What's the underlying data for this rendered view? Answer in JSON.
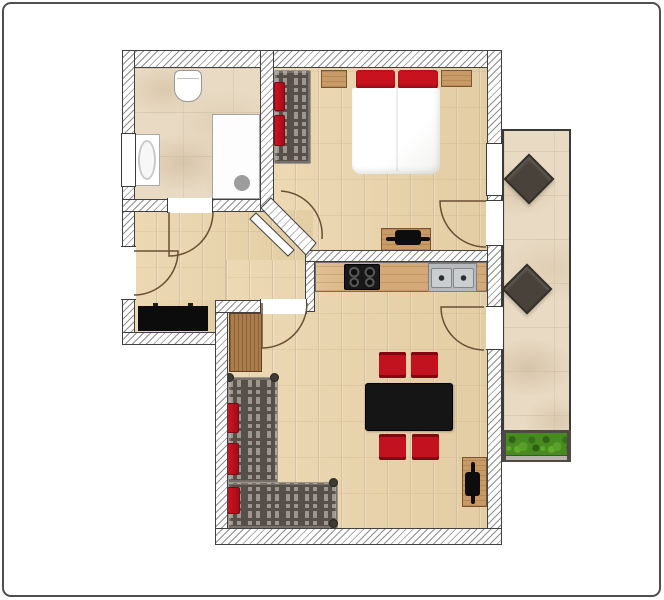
{
  "scene": {
    "title": "apartment-floor-plan",
    "canvas": {
      "w": 664,
      "h": 600,
      "bg": "#ffffff",
      "frame_color": "#4f4f4f"
    },
    "palette": {
      "wall_line": "#414141",
      "door_line": "#6b4f35",
      "wood_floor": "#e9d5ae",
      "stone_floor": "#e8dac3",
      "sofa_dark": "#57504a",
      "accent_red": "#c2121f",
      "furniture_black": "#151515",
      "plant_green": "#478a1f"
    },
    "floors": [
      {
        "name": "bathroom-floor",
        "kind": "stone",
        "x": 133,
        "y": 66,
        "w": 129,
        "h": 135
      },
      {
        "name": "bedroom-floor",
        "kind": "wood",
        "x": 272,
        "y": 66,
        "w": 216,
        "h": 186
      },
      {
        "name": "hallway-floor",
        "kind": "wood",
        "x": 133,
        "y": 210,
        "w": 180,
        "h": 94
      },
      {
        "name": "hallway-floor-ext",
        "kind": "wood",
        "x": 133,
        "y": 300,
        "w": 84,
        "h": 34
      },
      {
        "name": "living-room-floor",
        "kind": "wood",
        "x": 226,
        "y": 260,
        "w": 263,
        "h": 270
      },
      {
        "name": "balcony-floor",
        "kind": "balcony",
        "x": 502,
        "y": 129,
        "w": 69,
        "h": 333
      }
    ],
    "walls": [
      {
        "name": "wall-top",
        "x": 122,
        "y": 50,
        "w": 380,
        "h": 18
      },
      {
        "name": "wall-left",
        "x": 122,
        "y": 50,
        "w": 13,
        "h": 295
      },
      {
        "name": "wall-bathroom-bottom",
        "x": 122,
        "y": 199,
        "w": 152,
        "h": 13
      },
      {
        "name": "wall-bathroom-bedroom",
        "x": 260,
        "y": 50,
        "w": 14,
        "h": 162
      },
      {
        "name": "wall-hall-bottom-left",
        "x": 122,
        "y": 332,
        "w": 95,
        "h": 13
      },
      {
        "name": "wall-living-left",
        "x": 215,
        "y": 300,
        "w": 13,
        "h": 245
      },
      {
        "name": "wall-hall-bottom-right",
        "x": 215,
        "y": 300,
        "w": 92,
        "h": 13
      },
      {
        "name": "wall-mid-vertical",
        "x": 305,
        "y": 250,
        "w": 10,
        "h": 62
      },
      {
        "name": "wall-kitchen",
        "x": 305,
        "y": 250,
        "w": 197,
        "h": 12
      },
      {
        "name": "wall-right",
        "x": 487,
        "y": 50,
        "w": 15,
        "h": 495
      },
      {
        "name": "wall-bottom",
        "x": 215,
        "y": 528,
        "w": 287,
        "h": 17
      }
    ],
    "openings": [
      {
        "name": "bathroom-window-opening",
        "kind": "fp-win-v",
        "x": 121,
        "y": 133,
        "w": 15,
        "h": 54
      },
      {
        "name": "entrance-door-opening",
        "kind": "fp-open-v",
        "x": 121,
        "y": 246,
        "w": 15,
        "h": 54
      },
      {
        "name": "bathroom-door-opening",
        "kind": "fp-open-h",
        "x": 167,
        "y": 198,
        "w": 46,
        "h": 15
      },
      {
        "name": "hall-living-door-opening",
        "kind": "fp-open-h",
        "x": 260,
        "y": 299,
        "w": 47,
        "h": 15
      },
      {
        "name": "bedroom-window-opening",
        "kind": "fp-win-v",
        "x": 486,
        "y": 143,
        "w": 17,
        "h": 53
      },
      {
        "name": "bedroom-balcony-door-opening",
        "kind": "fp-open-v",
        "x": 486,
        "y": 200,
        "w": 17,
        "h": 46
      },
      {
        "name": "living-balcony-door-opening",
        "kind": "fp-open-v",
        "x": 486,
        "y": 306,
        "w": 17,
        "h": 44
      }
    ],
    "wall_polys": [
      {
        "name": "wall-bedroom-diagonal",
        "points": "271,198 316,243 306,255 261,208",
        "fill": "hatch"
      },
      {
        "name": "bedroom-door-leaf",
        "points": "256,213 294,250 288,256 250,219",
        "fill": "#ffffff"
      }
    ],
    "doors": [
      {
        "name": "entrance-door-swing",
        "path": "M 134,251 L 178,251 A 44,44 0 0 1 134,295"
      },
      {
        "name": "bathroom-door-swing",
        "path": "M 169,212 L 169,256 A 44,44 0 0 0 213,212"
      },
      {
        "name": "hall-living-door-swing",
        "path": "M 262,303 L 262,348 A 45,45 0 0 0 307,303"
      },
      {
        "name": "bedroom-door-swing",
        "path": "M 281,191 A 44,44 0 0 1 322,239"
      },
      {
        "name": "bedroom-balcony-door-swing",
        "path": "M 486,201 L 440,201 A 46,46 0 0 0 486,247"
      },
      {
        "name": "living-balcony-door-swing",
        "path": "M 484,307 L 441,307 A 43,43 0 0 0 484,350"
      }
    ],
    "furniture": [
      {
        "name": "toilet",
        "kind": "toilet",
        "x": 174,
        "y": 70,
        "w": 28,
        "h": 32
      },
      {
        "name": "bathroom-sink",
        "kind": "bathsink",
        "x": 134,
        "y": 134,
        "w": 26,
        "h": 52
      },
      {
        "name": "shower",
        "kind": "shower",
        "x": 212,
        "y": 114,
        "w": 48,
        "h": 85
      },
      {
        "name": "bedroom-bench",
        "kind": "plaid",
        "x": 274,
        "y": 70,
        "w": 37,
        "h": 94
      },
      {
        "name": "bedroom-bench-cushion",
        "kind": "cushion",
        "x": 274,
        "y": 82,
        "w": 11,
        "h": 29
      },
      {
        "name": "bedroom-bench-cushion",
        "kind": "cushion",
        "x": 274,
        "y": 115,
        "w": 11,
        "h": 31
      },
      {
        "name": "nightstand-left",
        "kind": "wood",
        "x": 321,
        "y": 70,
        "w": 26,
        "h": 18
      },
      {
        "name": "nightstand-right",
        "kind": "wood",
        "x": 441,
        "y": 70,
        "w": 31,
        "h": 17
      },
      {
        "name": "bed-pillow-left",
        "kind": "pillow",
        "x": 356,
        "y": 70,
        "w": 39,
        "h": 19
      },
      {
        "name": "bed-pillow-right",
        "kind": "pillow",
        "x": 398,
        "y": 70,
        "w": 40,
        "h": 19
      },
      {
        "name": "bed-duvet",
        "kind": "duvet",
        "x": 352,
        "y": 88,
        "w": 88,
        "h": 86
      },
      {
        "name": "bedroom-dresser",
        "kind": "wood",
        "x": 381,
        "y": 228,
        "w": 50,
        "h": 23
      },
      {
        "name": "dresser-soundbar-line",
        "kind": "tvbar",
        "x": 386,
        "y": 237,
        "w": 44,
        "h": 4
      },
      {
        "name": "dresser-soundbar",
        "kind": "tvbar",
        "x": 395,
        "y": 230,
        "w": 26,
        "h": 15
      },
      {
        "name": "kitchen-counter",
        "kind": "counter",
        "x": 315,
        "y": 262,
        "w": 172,
        "h": 30
      },
      {
        "name": "cooktop",
        "kind": "cooktop",
        "x": 344,
        "y": 264,
        "w": 36,
        "h": 26
      },
      {
        "name": "kitchen-sink",
        "kind": "ksink",
        "x": 428,
        "y": 263,
        "w": 49,
        "h": 29
      },
      {
        "name": "hallway-sideboard",
        "kind": "sideboard",
        "x": 138,
        "y": 306,
        "w": 70,
        "h": 25
      },
      {
        "name": "hallway-cabinet",
        "kind": "woodgrain",
        "x": 229,
        "y": 313,
        "w": 33,
        "h": 59
      },
      {
        "name": "sofa-arm-vertical",
        "kind": "plaid",
        "x": 228,
        "y": 377,
        "w": 50,
        "h": 106
      },
      {
        "name": "sofa-arm-horizontal",
        "kind": "plaid",
        "x": 228,
        "y": 482,
        "w": 110,
        "h": 47
      },
      {
        "name": "sofa-cushion",
        "kind": "cushion",
        "x": 227,
        "y": 403,
        "w": 12,
        "h": 30
      },
      {
        "name": "sofa-cushion",
        "kind": "cushion",
        "x": 227,
        "y": 443,
        "w": 12,
        "h": 32
      },
      {
        "name": "sofa-cushion",
        "kind": "cushion",
        "x": 227,
        "y": 487,
        "w": 13,
        "h": 27
      },
      {
        "name": "sofa-corner-post",
        "kind": "dot",
        "x": 225,
        "y": 373,
        "w": 9,
        "h": 9
      },
      {
        "name": "sofa-corner-post",
        "kind": "dot",
        "x": 270,
        "y": 373,
        "w": 9,
        "h": 9
      },
      {
        "name": "sofa-corner-post",
        "kind": "dot",
        "x": 329,
        "y": 478,
        "w": 9,
        "h": 9
      },
      {
        "name": "sofa-corner-post",
        "kind": "dot",
        "x": 329,
        "y": 519,
        "w": 9,
        "h": 9
      },
      {
        "name": "dining-table",
        "kind": "table",
        "x": 365,
        "y": 383,
        "w": 88,
        "h": 48
      },
      {
        "name": "dining-chair",
        "kind": "chair",
        "x": 379,
        "y": 352,
        "w": 27,
        "h": 26
      },
      {
        "name": "dining-chair",
        "kind": "chair",
        "x": 411,
        "y": 352,
        "w": 27,
        "h": 26
      },
      {
        "name": "dining-chair",
        "kind": "chair",
        "x": 379,
        "y": 434,
        "w": 27,
        "h": 26
      },
      {
        "name": "dining-chair",
        "kind": "chair",
        "x": 412,
        "y": 434,
        "w": 27,
        "h": 26
      },
      {
        "name": "tv-sideboard",
        "kind": "wood",
        "x": 462,
        "y": 457,
        "w": 25,
        "h": 50
      },
      {
        "name": "tv-line",
        "kind": "tvbar",
        "x": 471,
        "y": 462,
        "w": 4,
        "h": 42
      },
      {
        "name": "tv",
        "kind": "tvbar",
        "x": 465,
        "y": 472,
        "w": 15,
        "h": 24
      },
      {
        "name": "balcony-stool",
        "kind": "stool",
        "x": 511,
        "y": 161,
        "w": 36,
        "h": 36,
        "rot": 45
      },
      {
        "name": "balcony-stool",
        "kind": "stool",
        "x": 509,
        "y": 271,
        "w": 36,
        "h": 36,
        "rot": 45
      },
      {
        "name": "balcony-planter",
        "kind": "planter",
        "x": 502,
        "y": 430,
        "w": 69,
        "h": 32
      }
    ]
  }
}
